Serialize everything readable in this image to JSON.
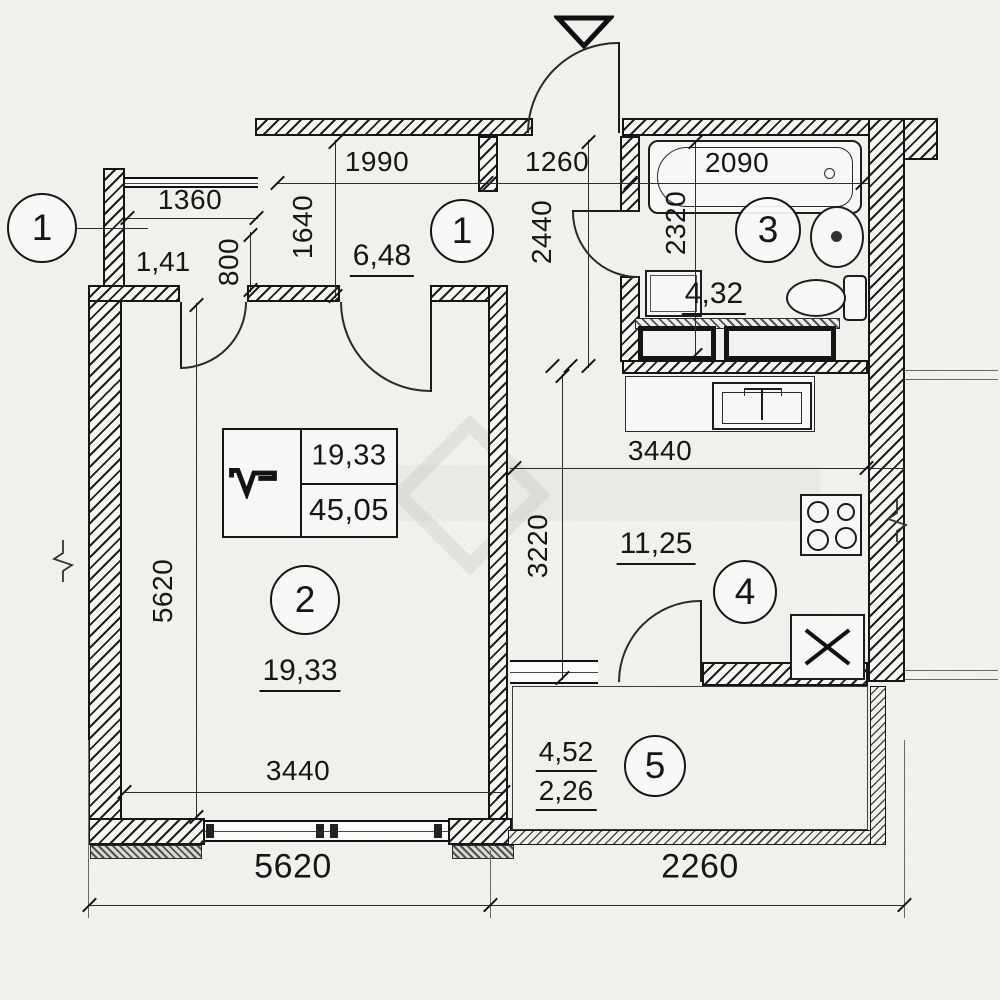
{
  "callouts": {
    "niche_external": "1",
    "hallway": "1",
    "living": "2",
    "bathroom": "3",
    "kitchen": "4",
    "balcony": "5"
  },
  "areas": {
    "hallway": "6,48",
    "niche": "1,41",
    "bathroom": "4,32",
    "living": "19,33",
    "kitchen": "11,25",
    "balcony_full": "4,52",
    "balcony_counted": "2,26"
  },
  "legend": {
    "living_area": "19,33",
    "total_area": "45,05"
  },
  "dimensions_mm": {
    "niche_width": "1360",
    "niche_depth": "800",
    "hall_width": "1990",
    "hall_depth": "1640",
    "entry_width": "1260",
    "entry_depth": "2440",
    "tub_length": "2090",
    "bath_depth": "2320",
    "kitchen_width": "3440",
    "kitchen_depth": "3220",
    "living_width": "3440",
    "living_depth": "5620",
    "overall_left": "5620",
    "overall_right": "2260"
  }
}
